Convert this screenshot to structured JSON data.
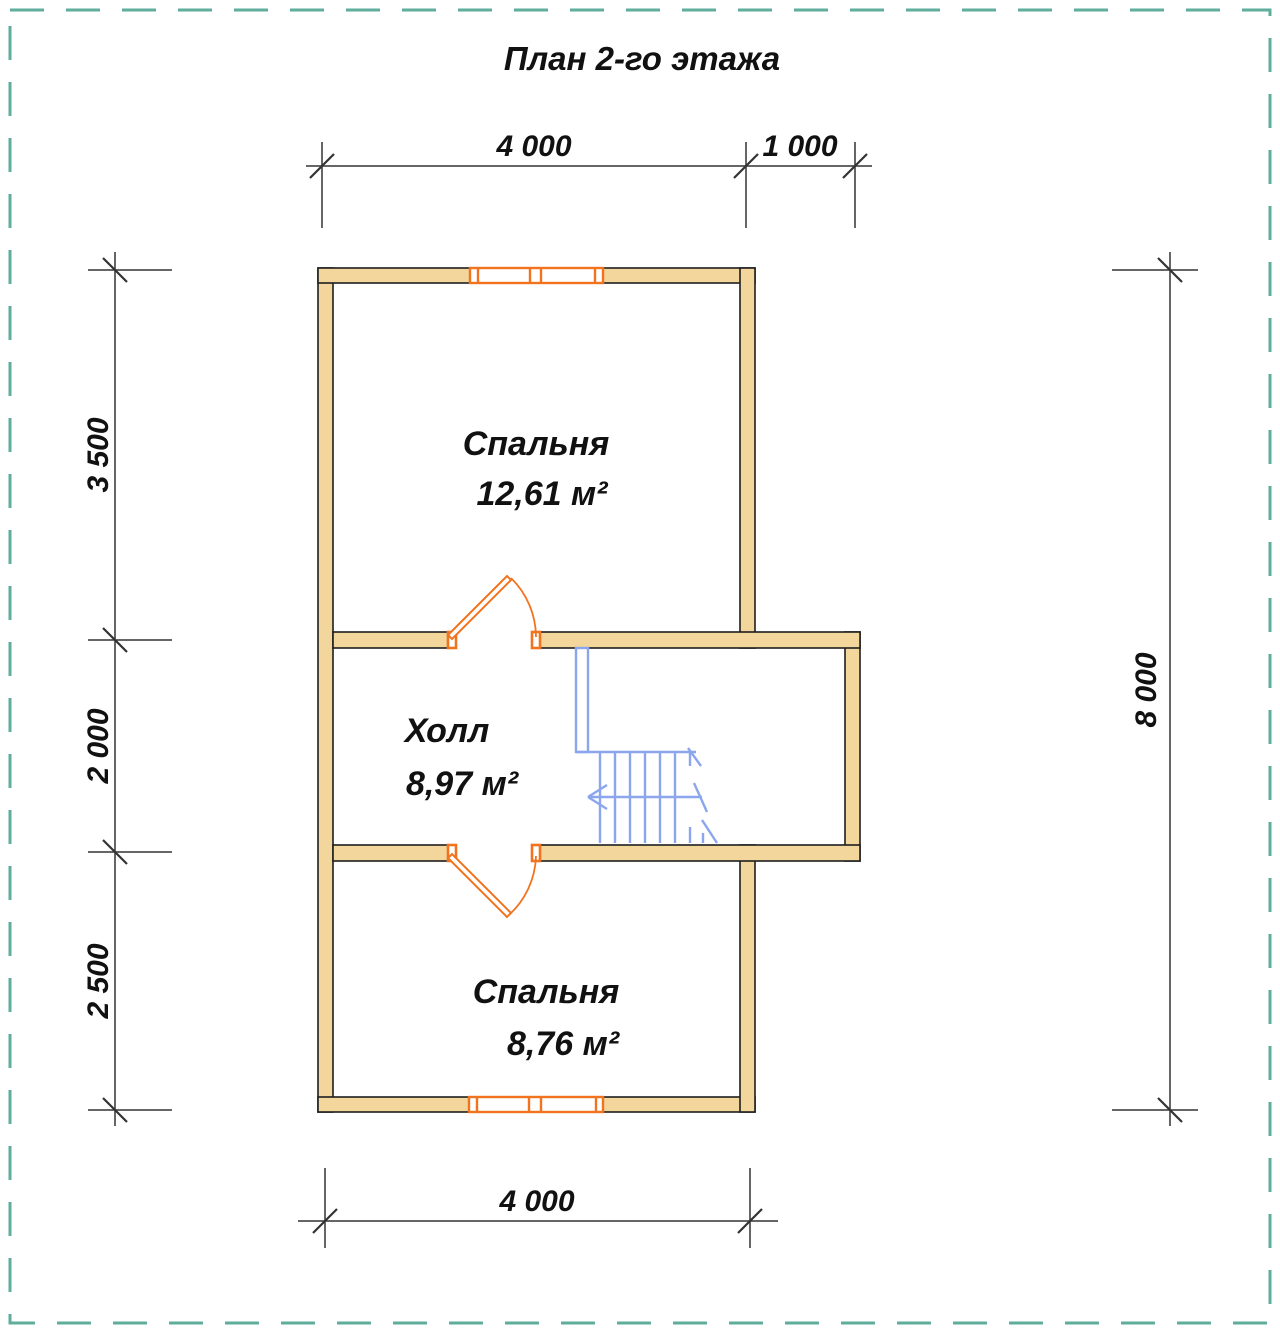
{
  "title": "План 2-го этажа",
  "colors": {
    "wall-fill": "#F2D69B",
    "wall-stroke": "#1E1E1E",
    "accent-orange": "#F2731E",
    "stair-blue": "#8CA6EE",
    "frame-teal": "#5FAE9C",
    "dim-line": "#333333",
    "text": "#111111"
  },
  "rooms": [
    {
      "name": "Спальня",
      "area": "12,61 м²"
    },
    {
      "name": "Холл",
      "area": "8,97 м²"
    },
    {
      "name": "Спальня",
      "area": "8,76 м²"
    }
  ],
  "dims": {
    "top": [
      "4 000",
      "1 000"
    ],
    "left": [
      "3 500",
      "2 000",
      "2 500"
    ],
    "right": [
      "8 000"
    ],
    "bottom": [
      "4 000"
    ]
  }
}
